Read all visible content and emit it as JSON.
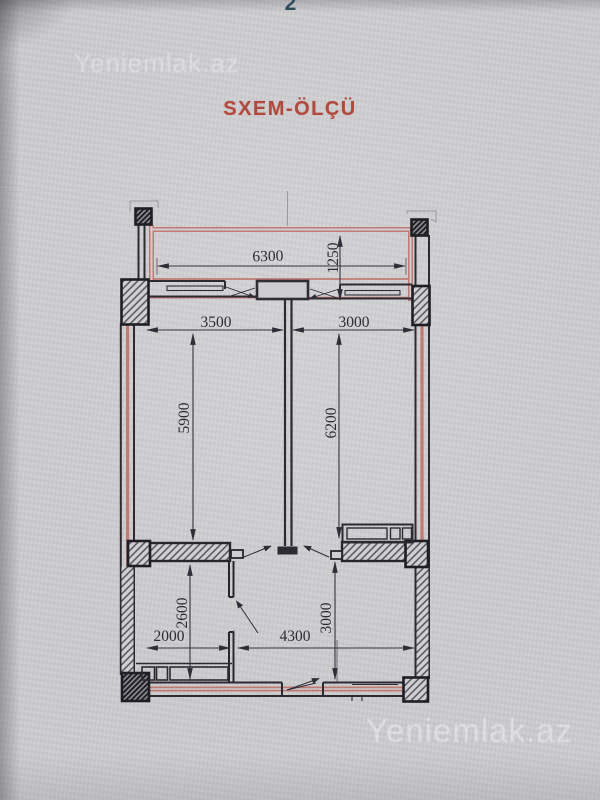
{
  "page": {
    "page_number": "2",
    "title": "SXEM-ÖLÇÜ",
    "watermarks": {
      "top_left": "Yeniemlak.az",
      "bottom_right": "Yeniemlak.az"
    }
  },
  "plan": {
    "kind": "apartment floor plan (scheme with measurements, mm)",
    "dims": {
      "balcony_width": "6300",
      "balcony_depth": "1250",
      "left_room_width": "3500",
      "right_room_width": "3000",
      "left_room_depth": "5900",
      "right_room_depth": "6200",
      "bath_depth": "2600",
      "bath_width": "2000",
      "hall_width": "4300",
      "hall_depth": "3000"
    },
    "colors": {
      "wall_accent_red": "#c0746c",
      "ink": "#2b2b31",
      "title_red": "#b14a3e",
      "page_number_teal": "#2d4d5a",
      "paper": "#cecdd0"
    }
  }
}
